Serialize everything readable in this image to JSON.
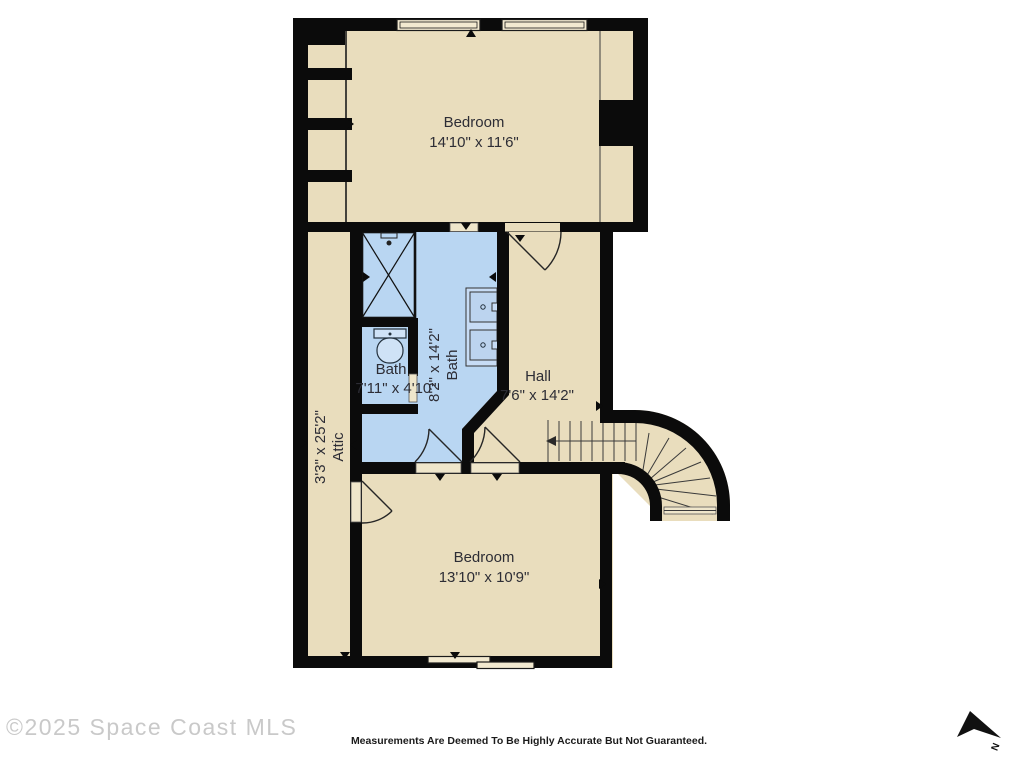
{
  "rooms": {
    "bedroom_top": {
      "name": "Bedroom",
      "dims": "14'10\" x 11'6\""
    },
    "bath_main": {
      "name": "Bath",
      "dims": "8'2\" x 14'2\""
    },
    "bath_small": {
      "name": "Bath",
      "dims": "7'11\" x 4'10\""
    },
    "hall": {
      "name": "Hall",
      "dims": "7'6\" x 14'2\""
    },
    "attic": {
      "name": "Attic",
      "dims": "3'3\" x 25'2\""
    },
    "bedroom_bottom": {
      "name": "Bedroom",
      "dims": "13'10\" x 10'9\""
    }
  },
  "footer": {
    "watermark": "©2025 Space Coast MLS",
    "disclaimer": "Measurements Are Deemed To Be Highly Accurate But Not Guaranteed.",
    "north_label": "N"
  },
  "colors": {
    "floor": "#e9ddbd",
    "bath_floor": "#b9d6f2",
    "wall": "#0b0b0b",
    "window_fill": "#f2e9d0",
    "label_text": "#2d2d35",
    "watermark_gray": "#c9c9c9"
  },
  "icons": [
    "north-arrow-icon",
    "shower-icon",
    "toilet-icon",
    "sink-icon",
    "stairs",
    "door-swing"
  ]
}
